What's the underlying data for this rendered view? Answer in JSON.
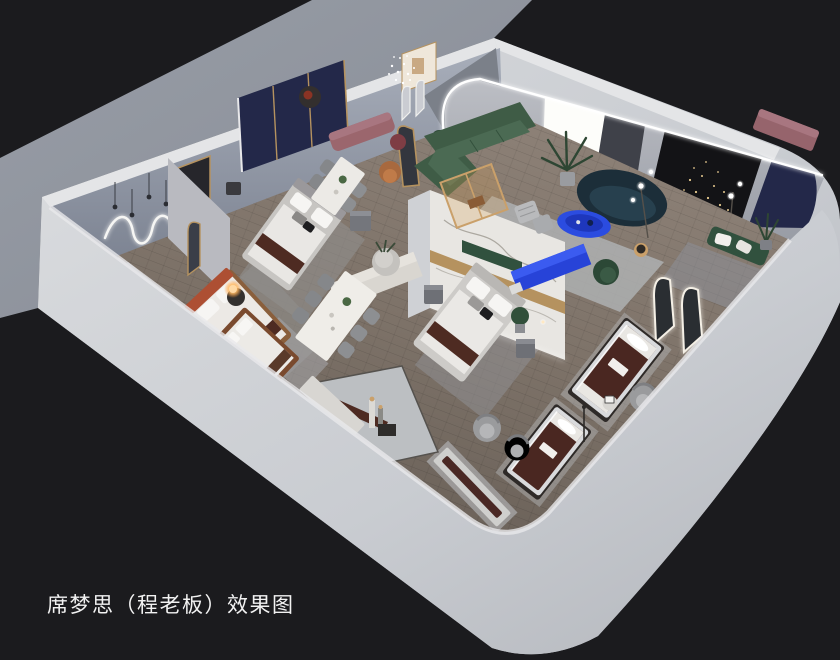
{
  "image": {
    "kind": "3d-interior-rendering",
    "subject": "isometric cutaway rendering of a mattress / bedding showroom with bedrooms, lounge and dining displays",
    "background_color": "#1b1b1e"
  },
  "caption": {
    "text": "席梦思（程老板）效果图",
    "color": "#f2f2f2"
  },
  "palette": {
    "backdrop": "#1b1b1e",
    "exterior_ground": "#8f949d",
    "outer_wall": "#cdd0d5",
    "wall_top_strip": "#e4e5e7",
    "interior_wall_nw": "#9aa1ae",
    "interior_wall_ne": "#b0b3ba",
    "wood_floor": "#7d7268",
    "marble_panel": "#e8e6e2",
    "gold_trim": "#b5925f",
    "green_sofa": "#3f5c46",
    "navy_sofa": "#1c2e39",
    "cobalt_blue_furniture": "#2b4ce0",
    "mauve_bench": "#9b666d",
    "mattress_brown": "#4a2721",
    "rust_headboard": "#ad4f33",
    "navy_wall_panel": "#232849",
    "black_accent_wall": "#131316",
    "led_light": "#ffffff",
    "warm_lamp": "#ffc37a"
  },
  "scene": {
    "rooms": [
      {
        "id": "bedroom-west",
        "label": "west bedroom with rust headboard bed and neon wall light"
      },
      {
        "id": "bedroom-center-left",
        "label": "center-left bedroom with navy-gold headboard wall"
      },
      {
        "id": "bedroom-center",
        "label": "center bedroom with marble feature wall"
      },
      {
        "id": "living-lounge",
        "label": "lounge with green sectional, navy curved sofa and blue tables"
      },
      {
        "id": "bedroom-east-dark",
        "label": "dark east bedroom with string lights and arched mirrors"
      },
      {
        "id": "dining-area",
        "label": "dining displays with marble tables"
      },
      {
        "id": "mattress-display-zone",
        "label": "mattress product displays along front walls"
      }
    ],
    "objects": [
      {
        "id": "neon-squiggle-light",
        "label": "white neon squiggle wall light"
      },
      {
        "id": "pendant-bulbs",
        "label": "hanging bulb pendants"
      },
      {
        "id": "crystal-pendant",
        "label": "crystal cluster pendant"
      },
      {
        "id": "bed-west",
        "label": "bed with rust headboard"
      },
      {
        "id": "glow-lamp",
        "label": "glowing sphere table lamp"
      },
      {
        "id": "bed-center-left",
        "label": "upholstered bed with brown runner"
      },
      {
        "id": "headboard-wall-navy",
        "label": "navy panel headboard wall with gold trim"
      },
      {
        "id": "floor-mirror",
        "label": "gold framed arched floor mirror"
      },
      {
        "id": "dining-table-4",
        "label": "four seat dining table"
      },
      {
        "id": "dining-table-6",
        "label": "six seat dining table"
      },
      {
        "id": "mauve-bench",
        "label": "mauve upholstered bench"
      },
      {
        "id": "marble-feature-wall",
        "label": "marble partition with gold band"
      },
      {
        "id": "bed-center",
        "label": "bed against marble wall"
      },
      {
        "id": "green-sectional",
        "label": "dark green L sectional sofa"
      },
      {
        "id": "glass-partition",
        "label": "wood framed glass partition"
      },
      {
        "id": "light-box",
        "label": "glowing light box wall panel"
      },
      {
        "id": "navy-curved-sofa",
        "label": "navy curved sofa"
      },
      {
        "id": "blue-coffee-table",
        "label": "cobalt blue oval coffee table"
      },
      {
        "id": "blue-console",
        "label": "cobalt blue media console"
      },
      {
        "id": "led-arch",
        "label": "LED cove arch over lounge"
      },
      {
        "id": "black-accent-wall",
        "label": "black accent wall with cascading lights"
      },
      {
        "id": "arched-mirrors",
        "label": "LED trimmed arched mirrors"
      },
      {
        "id": "green-bench-east",
        "label": "green bench with pillows"
      },
      {
        "id": "mattress-display-1",
        "label": "brown mattress display"
      },
      {
        "id": "mattress-display-2",
        "label": "brown mattress display"
      },
      {
        "id": "display-bed-wood",
        "label": "wood frame display bed"
      },
      {
        "id": "lean-display-bench",
        "label": "leaning mattress display bench"
      },
      {
        "id": "barrel-chairs",
        "label": "gray barrel swivel chairs"
      },
      {
        "id": "marble-floor-inset",
        "label": "marble floor inset with cylinder lamps"
      },
      {
        "id": "entry-marble-strip",
        "label": "marble walkway strip along front wall"
      }
    ]
  }
}
